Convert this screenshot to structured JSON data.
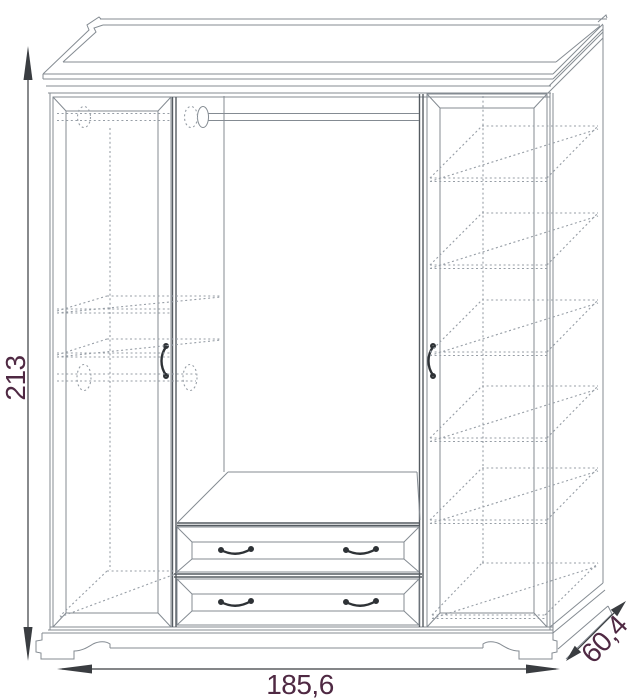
{
  "diagram": {
    "kind": "furniture technical drawing",
    "subject": "three-door wardrobe, front elevation with perspective depth, hidden shelves and rods shown dashed",
    "labels": {
      "height": "213",
      "width": "185,6",
      "depth": "60,4"
    },
    "colors": {
      "line": "#848b92",
      "line_dark": "#555b61",
      "hidden_line": "#979ea6",
      "dimension": "#3a3d41",
      "label": "#4f2943",
      "background": "#ffffff"
    },
    "parts": {
      "doors": 2,
      "drawers": 2,
      "hanging_rods": 2,
      "right_section_shelves": 5
    }
  }
}
